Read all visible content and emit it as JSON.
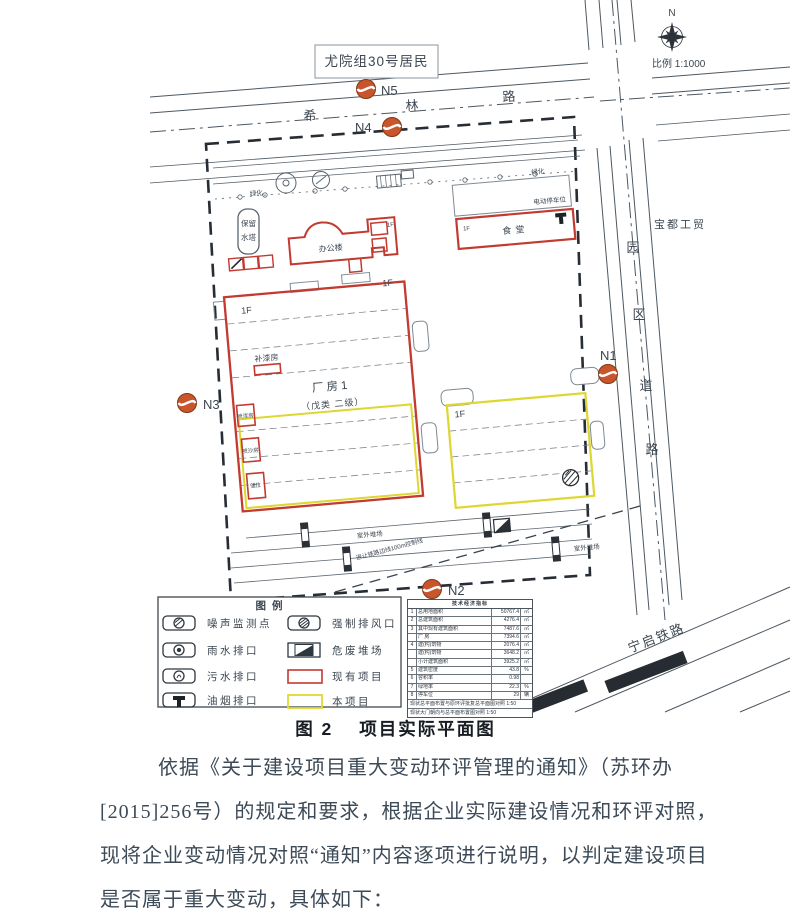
{
  "figure": {
    "resident_label": "尤院组30号居民",
    "compass_n": "N",
    "scale_label": "比例 1:1000",
    "roads": {
      "xilin": [
        "希",
        "林",
        "路"
      ],
      "park": [
        "园",
        "区",
        "道",
        "路"
      ],
      "baodu_label": "宝都工贸",
      "railway_label": "宁启铁路"
    },
    "points": {
      "n1": "N1",
      "n2": "N2",
      "n3": "N3",
      "n4": "N4",
      "n5": "N5"
    },
    "labels": {
      "factory_name": "厂房1",
      "factory_class": "（戊类 二级）",
      "floor": "1F",
      "paint_repair": "补漆房",
      "spray_paint": "喷漆房",
      "sand_blast": "喷沙房",
      "storage": "储位",
      "office": "办公楼",
      "canteen": "食堂",
      "ev_parking": "电动停车位",
      "green": "绿化",
      "water_tower_l1": "保留",
      "water_tower_l2": "水塔",
      "yard": "室外堆场",
      "setback": "退让铁路边线100m控制线"
    },
    "legend": {
      "title": "图例",
      "left": [
        "噪声监测点",
        "雨水排口",
        "污水排口",
        "油烟排口"
      ],
      "right": [
        "强制排风口",
        "危废堆场",
        "现有项目",
        "本项目"
      ]
    },
    "table": {
      "title": "技术经济指标",
      "rows": [
        {
          "no": "1",
          "label": "总用地面积",
          "value": "50767.4",
          "unit": "㎡"
        },
        {
          "no": "2",
          "label": "总建筑面积",
          "value": "4276.4",
          "unit": "㎡"
        },
        {
          "no": "3",
          "label": "其中现有建筑面积",
          "value": "7487.6",
          "unit": "㎡"
        },
        {
          "no": "",
          "label": "厂 房",
          "value": "7394.6",
          "unit": "㎡"
        },
        {
          "no": "4",
          "label": "建(构)筑物",
          "value": "2076.4",
          "unit": "㎡"
        },
        {
          "no": "",
          "label": "建(构)筑物",
          "value": "3648.2",
          "unit": "㎡"
        },
        {
          "no": "",
          "label": "小计建筑面积",
          "value": "3925.2",
          "unit": "㎡"
        },
        {
          "no": "5",
          "label": "建筑密度",
          "value": "43.8",
          "unit": "%"
        },
        {
          "no": "6",
          "label": "容积率",
          "value": "0.98",
          "unit": ""
        },
        {
          "no": "7",
          "label": "绿地率",
          "value": "22.3",
          "unit": "%"
        },
        {
          "no": "8",
          "label": "停车位",
          "value": "29",
          "unit": "辆"
        }
      ],
      "notes": [
        "现状总平面布置与原环评批复总平面图对照 1:50",
        "现状大门朝向与总平面布置图对照 1:50"
      ]
    },
    "colors": {
      "existing": "#c23a30",
      "proposed": "#ded631",
      "monitor": "#c8552c"
    }
  },
  "caption": {
    "fig_no": "图 2",
    "title": "项目实际平面图"
  },
  "body": {
    "lines": [
      "依据《关于建设项目重大变动环评管理的通知》（苏环办",
      "[2015]256号）的规定和要求，根据企业实际建设情况和环评对照，",
      "现将企业变动情况对照“通知”内容逐项进行说明，以判定建设项目",
      "是否属于重大变动，具体如下："
    ]
  }
}
